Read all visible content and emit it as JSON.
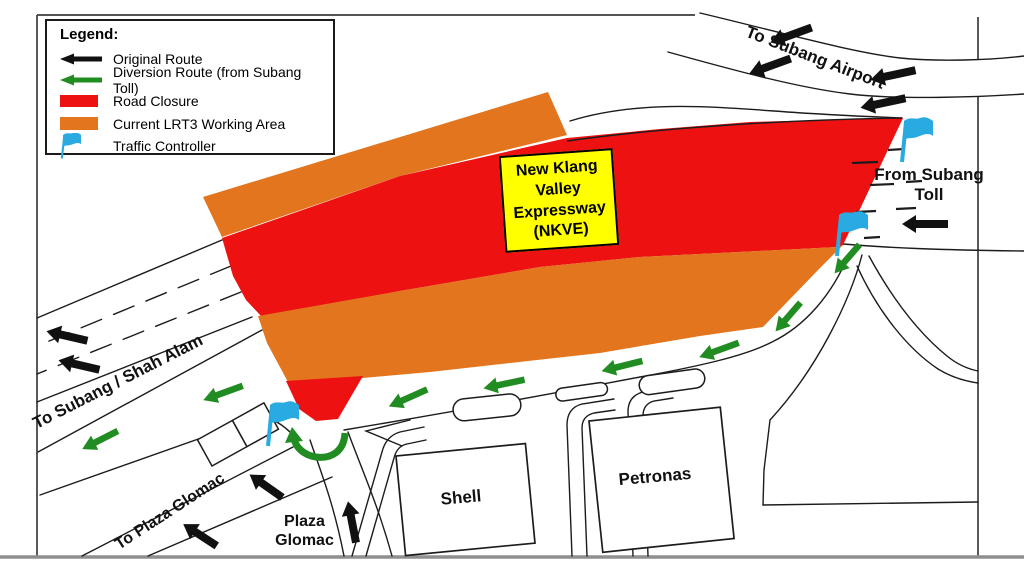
{
  "palette": {
    "red": "#EE1111",
    "orange": "#E2751E",
    "green": "#218C21",
    "black": "#111111",
    "flag_blue": "#29ABE2",
    "yellow": "#FFFF00",
    "road_line": "#1c1c1c",
    "frame": "#3c3c3c",
    "bottom_bar": "#8f8f8f"
  },
  "legend": {
    "title": "Legend:",
    "items": [
      {
        "swatch": "black-arrow",
        "label": "Original Route"
      },
      {
        "swatch": "green-arrow",
        "label": "Diversion Route (from Subang Toll)"
      },
      {
        "swatch": "red-box",
        "label": "Road Closure"
      },
      {
        "swatch": "orange-box",
        "label": "Current LRT3 Working Area"
      },
      {
        "swatch": "flag",
        "label": "Traffic Controller"
      }
    ]
  },
  "labels": {
    "airport": "To Subang Airport",
    "toll": "From Subang Toll",
    "shah_alam": "To Subang / Shah Alam",
    "plaza_road": "To Plaza Glomac",
    "plaza": "Plaza Glomac",
    "shell": "Shell",
    "petronas": "Petronas",
    "nkve_lines": [
      "New Klang",
      "Valley",
      "Expressway",
      "(NKVE)"
    ]
  },
  "map": {
    "arrows": [
      {
        "kind": "original",
        "x": 791,
        "y": 35,
        "rot": -20,
        "len": 44
      },
      {
        "kind": "original",
        "x": 770,
        "y": 66,
        "rot": -20,
        "len": 44
      },
      {
        "kind": "original",
        "x": 893,
        "y": 75,
        "rot": -12,
        "len": 46
      },
      {
        "kind": "original",
        "x": 883,
        "y": 103,
        "rot": -12,
        "len": 46
      },
      {
        "kind": "original",
        "x": 925,
        "y": 224,
        "rot": 0,
        "len": 46
      },
      {
        "kind": "original",
        "x": 67,
        "y": 336,
        "rot": 13,
        "len": 42
      },
      {
        "kind": "original",
        "x": 79,
        "y": 365,
        "rot": 13,
        "len": 42
      },
      {
        "kind": "original",
        "x": 266,
        "y": 486,
        "rot": 35,
        "len": 40
      },
      {
        "kind": "original",
        "x": 200,
        "y": 535,
        "rot": 33,
        "len": 40
      },
      {
        "kind": "original",
        "x": 352,
        "y": 522,
        "rot": 79,
        "len": 42
      },
      {
        "kind": "diversion",
        "x": 847,
        "y": 259,
        "rot": -49,
        "len": 38
      },
      {
        "kind": "diversion",
        "x": 788,
        "y": 317,
        "rot": -49,
        "len": 38
      },
      {
        "kind": "diversion",
        "x": 719,
        "y": 350,
        "rot": -20,
        "len": 42
      },
      {
        "kind": "diversion",
        "x": 622,
        "y": 366,
        "rot": -14,
        "len": 42
      },
      {
        "kind": "diversion",
        "x": 504,
        "y": 384,
        "rot": -12,
        "len": 42
      },
      {
        "kind": "diversion",
        "x": 408,
        "y": 398,
        "rot": -24,
        "len": 42
      },
      {
        "kind": "diversion",
        "x": 223,
        "y": 393,
        "rot": -20,
        "len": 42
      },
      {
        "kind": "diversion",
        "x": 100,
        "y": 440,
        "rot": -27,
        "len": 40
      }
    ],
    "flags": [
      {
        "x": 899,
        "y": 118
      },
      {
        "x": 834,
        "y": 212
      },
      {
        "x": 265,
        "y": 402
      }
    ],
    "dashes": [
      [
        852,
        163,
        26
      ],
      [
        888,
        150,
        16
      ],
      [
        870,
        185,
        24
      ],
      [
        906,
        182,
        16
      ],
      [
        856,
        212,
        20
      ],
      [
        896,
        209,
        20
      ],
      [
        864,
        238,
        16
      ]
    ]
  }
}
